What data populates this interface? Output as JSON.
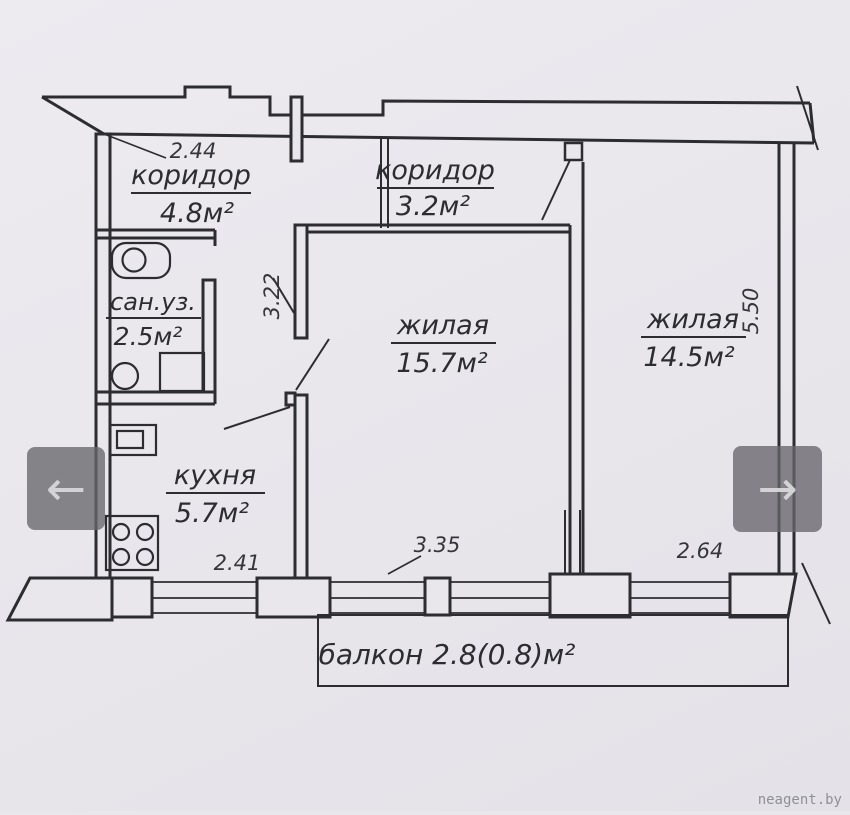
{
  "plan": {
    "rooms": {
      "corridor_entry": {
        "name": "коридор",
        "area": "4.8м²"
      },
      "corridor_inner": {
        "name": "коридор",
        "area": "3.2м²"
      },
      "bathroom": {
        "name": "сан.уз.",
        "area": "2.5м²"
      },
      "living_main": {
        "name": "жилая",
        "area": "15.7м²"
      },
      "living_second": {
        "name": "жилая",
        "area": "14.5м²"
      },
      "kitchen": {
        "name": "кухня",
        "area": "5.7м²"
      },
      "balcony": {
        "label": "балкон 2.8(0.8)м²"
      }
    },
    "dimensions": {
      "entry_width": "2.44",
      "living_main_depth": "3.22",
      "kitchen_width": "2.41",
      "living_main_width": "3.35",
      "living_second_width": "2.64",
      "living_second_depth": "5.50"
    },
    "colors": {
      "line": "#2c2c31",
      "paper": "#e9e7ec"
    }
  },
  "viewer": {
    "prev_icon": "←",
    "next_icon": "→",
    "watermark": "neagent.by"
  }
}
